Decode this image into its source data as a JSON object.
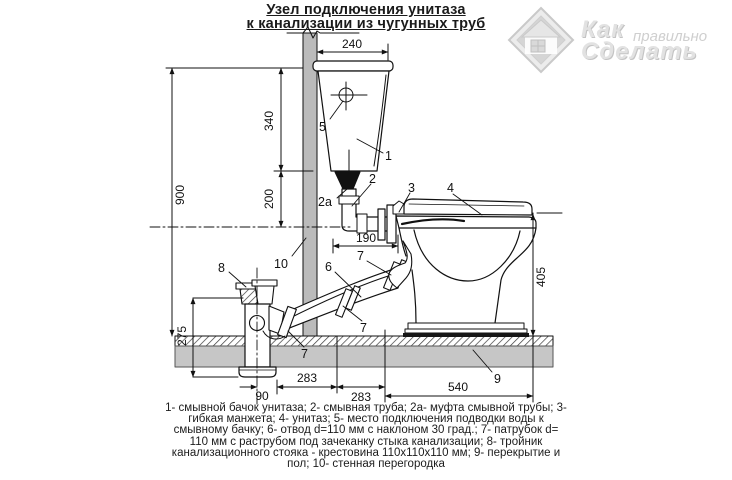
{
  "title": {
    "line1": "Узел подключения унитаза",
    "line2": "к канализации из чугунных труб"
  },
  "watermark": {
    "word_top": "Как",
    "word_mid": "правильно",
    "word_bottom": "Сделать"
  },
  "dimensions": {
    "d240": "240",
    "d900": "900",
    "d340": "340",
    "d200": "200",
    "d190": "190",
    "d405": "405",
    "d275": "275",
    "d90": "90",
    "d283a": "283",
    "d283b": "283",
    "d540": "540"
  },
  "part_labels": {
    "n1": "1",
    "n2": "2",
    "n2a": "2a",
    "n3": "3",
    "n4": "4",
    "n5": "5",
    "n6": "6",
    "n7": "7",
    "n8": "8",
    "n9": "9",
    "n10": "10"
  },
  "legend": {
    "lines": [
      "1- смывной бачок унитаза;  2- смывная труба; 2а- муфта смывной трубы;  3-",
      "гибкая  манжета;  4- унитаз;  5- место подключения подводки воды к",
      "смывному бачку; 6- отвод d=110 мм с наклоном 30 град.;  7-  патрубок d=",
      "110 мм с раструбом под зачеканку стыка канализации;  8- тройник",
      "канализационного стояка - крестовина 110х110х110 мм;  9- перекрытие и",
      "пол;  10- стенная перегородка"
    ]
  },
  "colors": {
    "wall_gray": "#bbbbbb",
    "floor_gray": "#c6c6c6",
    "line_black": "#1a1a1a",
    "watermark_gray": "#d8d8d8"
  }
}
